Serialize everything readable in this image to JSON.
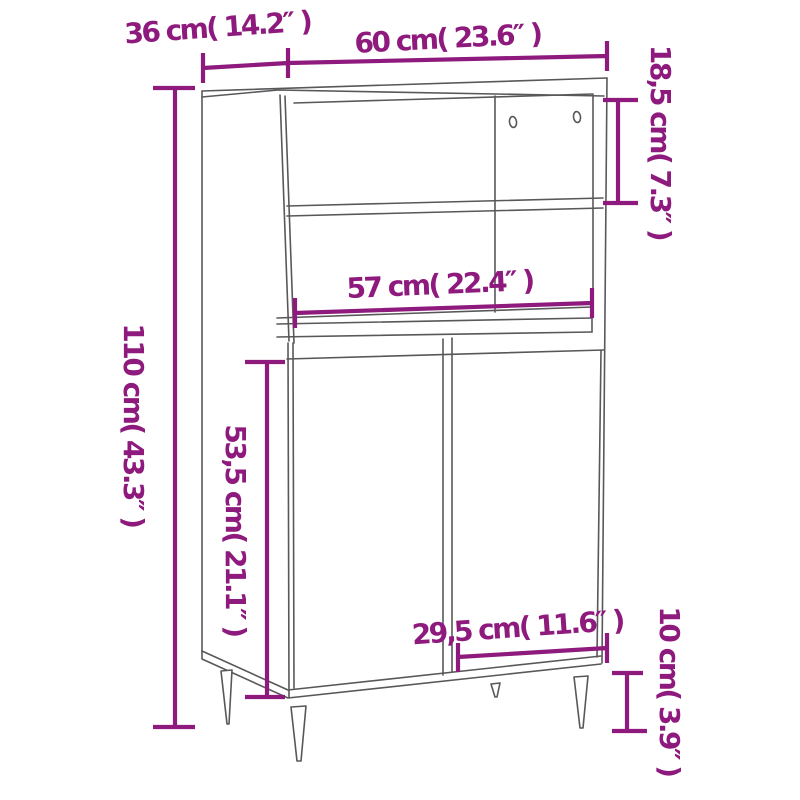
{
  "diagram": {
    "kind": "furniture-dimension-drawing",
    "accent_color": "#8e1a7d",
    "line_color": "#58585b",
    "background_color": "#ffffff",
    "dimensions": {
      "top_depth": {
        "label": "36 cm( 14.2″ )",
        "cm": "36",
        "inches": "14.2"
      },
      "top_width": {
        "label": "60 cm( 23.6″ )",
        "cm": "60",
        "inches": "23.6"
      },
      "total_height": {
        "label": "110 cm( 43.3″ )",
        "cm": "110",
        "inches": "43.3"
      },
      "open_shelf_height": {
        "label": "18,5 cm( 7.3″ )",
        "cm": "18,5",
        "inches": "7.3"
      },
      "inner_width": {
        "label": "57 cm( 22.4″ )",
        "cm": "57",
        "inches": "22.4"
      },
      "door_height": {
        "label": "53,5 cm( 21.1″ )",
        "cm": "53,5",
        "inches": "21.1"
      },
      "door_width": {
        "label": "29,5 cm( 11.6″ )",
        "cm": "29,5",
        "inches": "11.6"
      },
      "leg_height": {
        "label": "10 cm( 3.9″ )",
        "cm": "10",
        "inches": "3.9"
      }
    }
  }
}
